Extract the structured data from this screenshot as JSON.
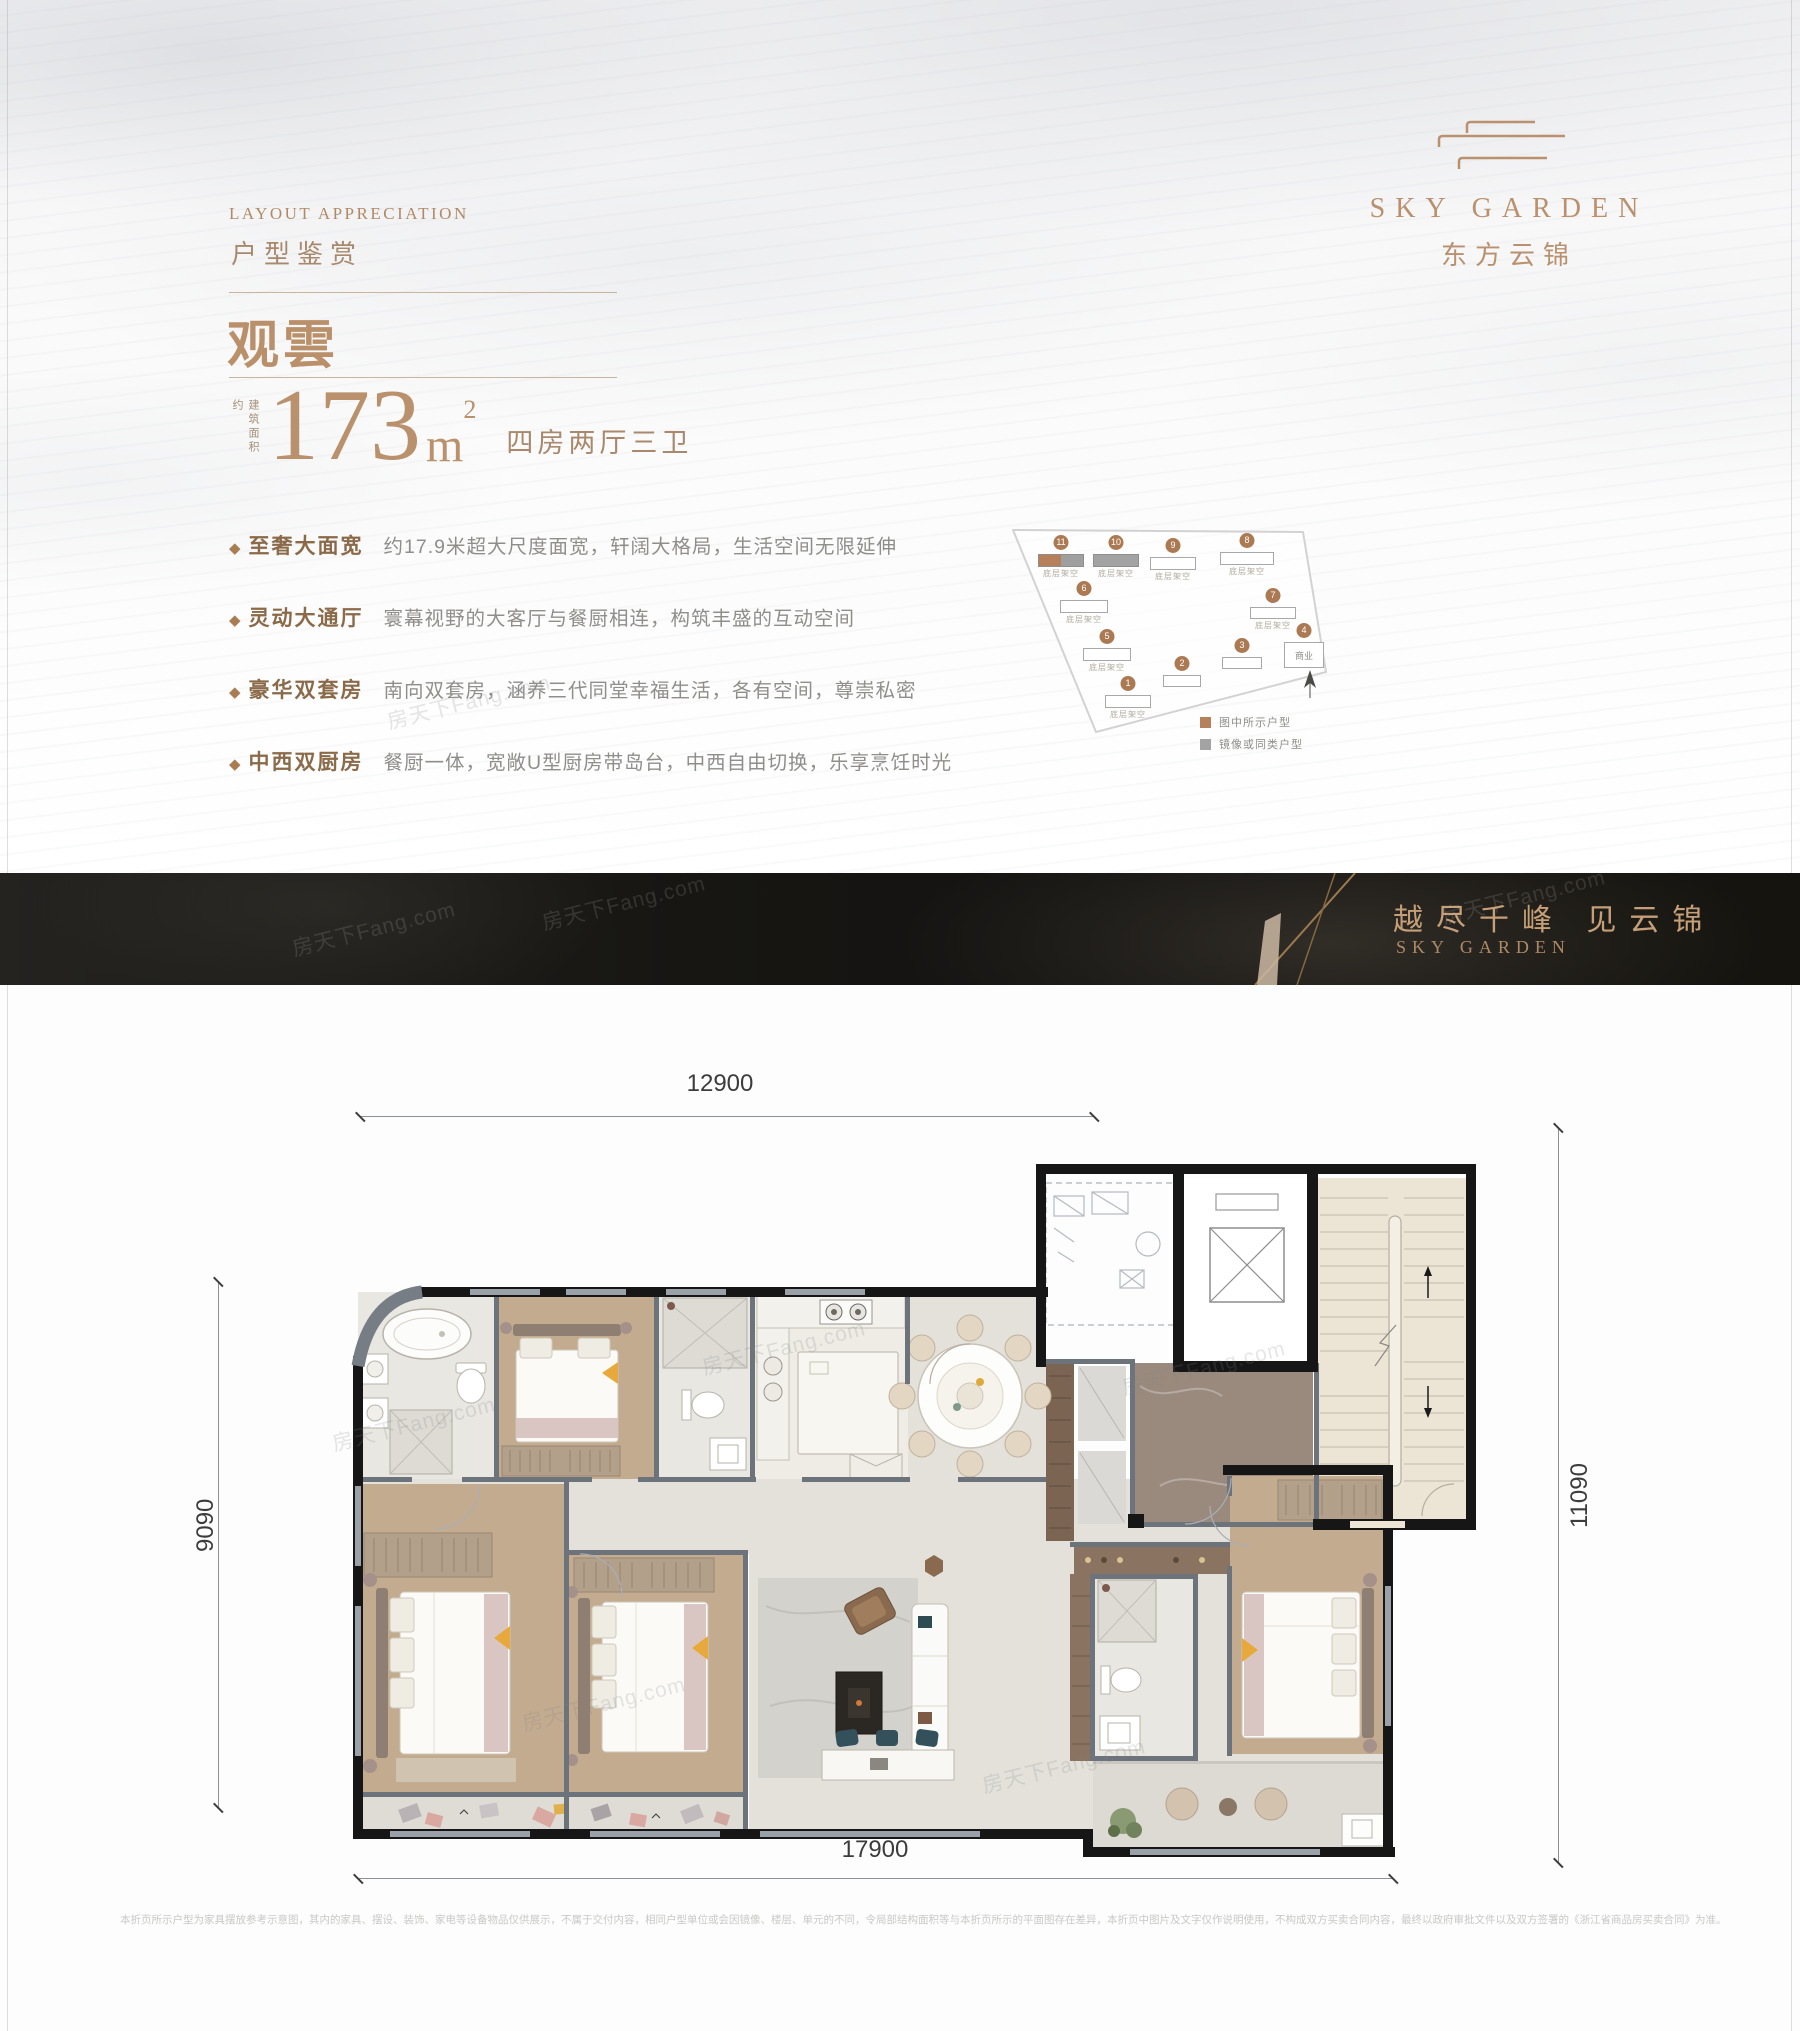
{
  "header": {
    "eyebrow_en": "LAYOUT APPRECIATION",
    "eyebrow_cn": "户型鉴赏",
    "unit_name": "观雲",
    "area_prefix": "建筑面积约",
    "area_value": "173",
    "area_unit_letter": "m",
    "area_unit_sup": "2",
    "room_type": "四房两厅三卫"
  },
  "features": [
    {
      "bullet": "◆",
      "label": "至奢大面宽",
      "desc": "约17.9米超大尺度面宽，轩阔大格局，生活空间无限延伸"
    },
    {
      "bullet": "◆",
      "label": "灵动大通厅",
      "desc": "寰幕视野的大客厅与餐厨相连，构筑丰盛的互动空间"
    },
    {
      "bullet": "◆",
      "label": "豪华双套房",
      "desc": "南向双套房，涵养三代同堂幸福生活，各有空间，尊崇私密"
    },
    {
      "bullet": "◆",
      "label": "中西双厨房",
      "desc": "餐厨一体，宽敞U型厨房带岛台，中西自由切换，乐享烹饪时光"
    }
  ],
  "logo": {
    "en": "SKY GARDEN",
    "cn": "东方云锦"
  },
  "siteplan": {
    "buildings": [
      {
        "number": "1",
        "caption": "底层架空"
      },
      {
        "number": "2",
        "caption": ""
      },
      {
        "number": "3",
        "caption": ""
      },
      {
        "number": "4",
        "caption": "商业"
      },
      {
        "number": "5",
        "caption": "底层架空"
      },
      {
        "number": "6",
        "caption": "底层架空"
      },
      {
        "number": "7",
        "caption": "底层架空"
      },
      {
        "number": "8",
        "caption": "底层架空"
      },
      {
        "number": "9",
        "caption": "底层架空"
      },
      {
        "number": "10",
        "caption": "底层架空"
      },
      {
        "number": "11",
        "caption": "底层架空"
      }
    ],
    "legend": [
      {
        "label": "图中所示户型",
        "color": "#b5805a"
      },
      {
        "label": "镜像或同类户型",
        "color": "#a3a3a3"
      }
    ]
  },
  "banner": {
    "slogan": "越尽千峰  见云锦",
    "brand": "SKY GARDEN"
  },
  "floorplan": {
    "dim_top": "12900",
    "dim_left": "9090",
    "dim_right": "11090",
    "dim_bottom": "17900"
  },
  "watermark": "房天下Fang.com",
  "disclaimer": "本折页所示户型为家具摆放参考示意图，其内的家具、摆设、装饰、家电等设备物品仅供展示，不属于交付内容，相同户型单位或会因镜像、楼层、单元的不同，令局部结构面积等与本折页所示的平面图存在差异，本折页中图片及文字仅作说明使用，不构成双方买卖合同内容，最终以政府审批文件以及双方签署的《浙江省商品房买卖合同》为准。",
  "colors": {
    "accent": "#b9916f",
    "highlight_unit": "#b5805a",
    "mirror_unit": "#a3a3a3",
    "banner_bg": "#161511"
  }
}
